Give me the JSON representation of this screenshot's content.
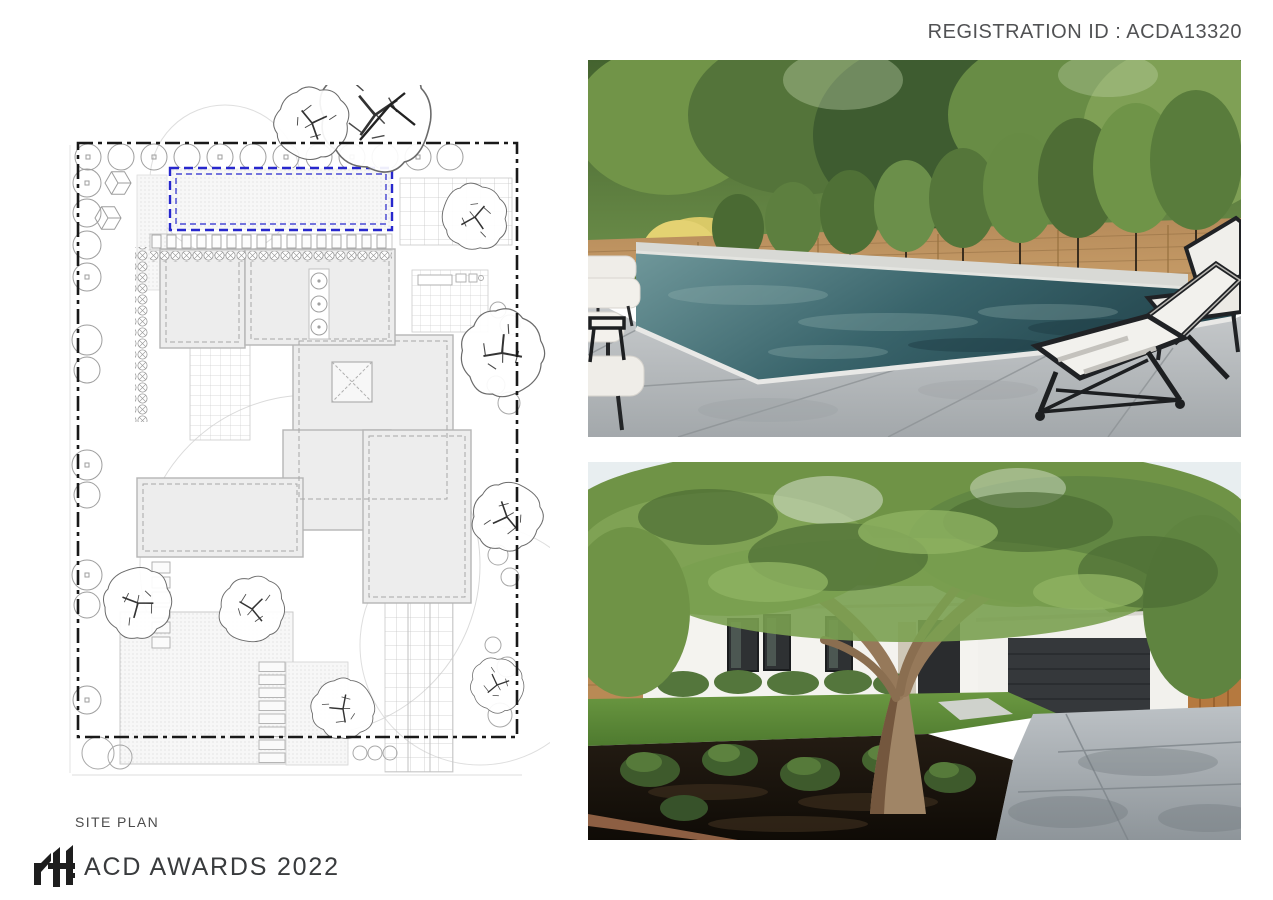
{
  "header": {
    "registration_label": "REGISTRATION ID : ACDA13320",
    "text_color": "#515254"
  },
  "site_plan": {
    "caption": "SITE PLAN",
    "pool_outline_color": "#2727cd",
    "boundary_color": "#1a1a1a",
    "building_fill": "#ededed",
    "line_color": "#9e9e9e"
  },
  "photos": {
    "pool": {
      "name": "backyard-pool-photo",
      "water_color": "#2e565e",
      "deck_color": "#c3c7c9",
      "fence_color": "#b68b5a",
      "lounge_frame_color": "#202225",
      "cushion_color": "#f2f1ed"
    },
    "house": {
      "name": "house-front-photo",
      "wall_color": "#f3f2ee",
      "garage_door_color": "#35383b",
      "lawn_color": "#5d8f3c",
      "mulch_color": "#1b140d",
      "driveway_color": "#aeb4b8",
      "canopy_color": "#6f9346"
    }
  },
  "footer": {
    "logo_name": "rtf-logo",
    "award_text": "ACD AWARDS 2022"
  }
}
